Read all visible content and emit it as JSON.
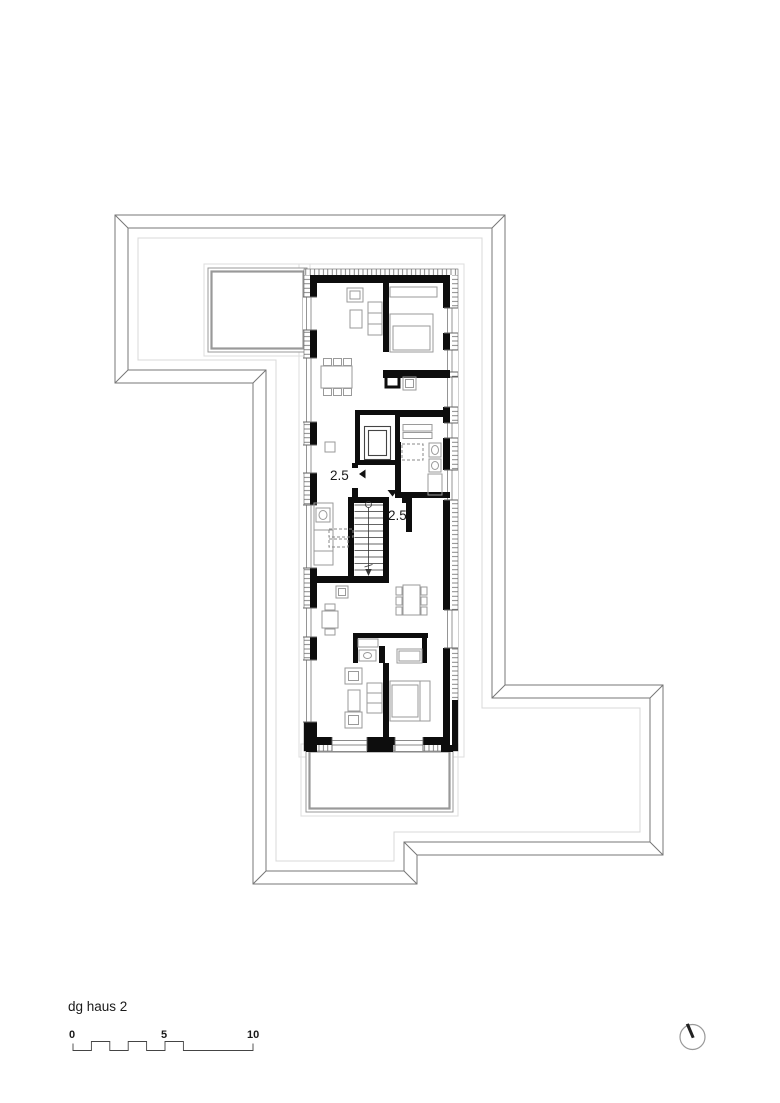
{
  "title_block": {
    "title": "dg haus 2"
  },
  "plan": {
    "units": [
      {
        "label": "2.5",
        "entry_marker": "left-arrow"
      },
      {
        "label": "2.5",
        "entry_marker": "down-arrow"
      }
    ]
  },
  "scale_bar": {
    "ticks": [
      "0",
      "5",
      "10"
    ]
  },
  "icons": {
    "north": "north-arrow"
  },
  "colors": {
    "wall": "#0d0d0d",
    "outline": "#777777",
    "furniture": "#9a9a9a",
    "glazing": "#8a8a8a",
    "light": "#d9d9d9",
    "terrace": "#999999"
  }
}
